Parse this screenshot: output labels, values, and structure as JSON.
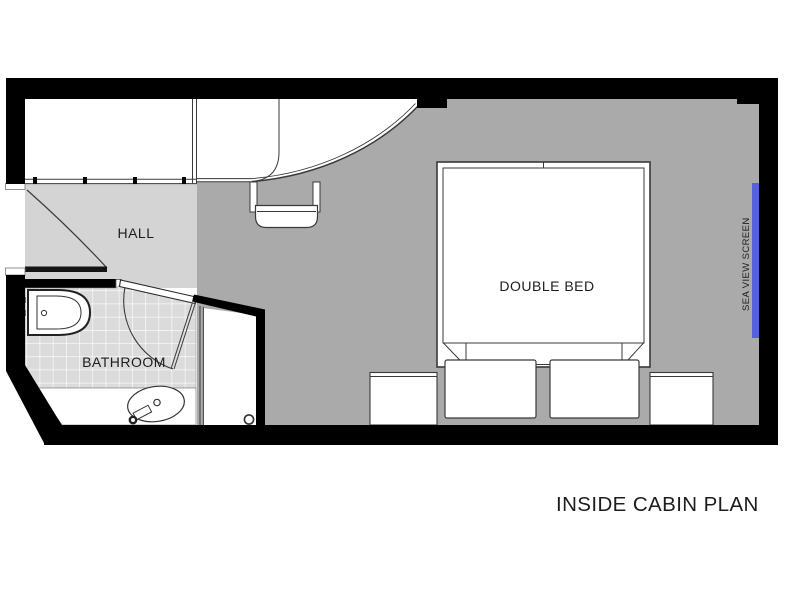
{
  "title": "INSIDE CABIN PLAN",
  "labels": {
    "hall": "HALL",
    "bathroom": "BATHROOM",
    "double_bed": "DOUBLE BED",
    "sea_view_screen": "SEA VIEW SCREEN"
  },
  "colors": {
    "wall": "#000000",
    "bedroom_floor": "#aaaaaa",
    "hall_floor": "#d4d4d4",
    "tile": "#dbdbdb",
    "tile_line": "#ffffff",
    "screen_blue": "#5560e0",
    "line": "#3a3a3a",
    "text": "#1d1d1d"
  }
}
